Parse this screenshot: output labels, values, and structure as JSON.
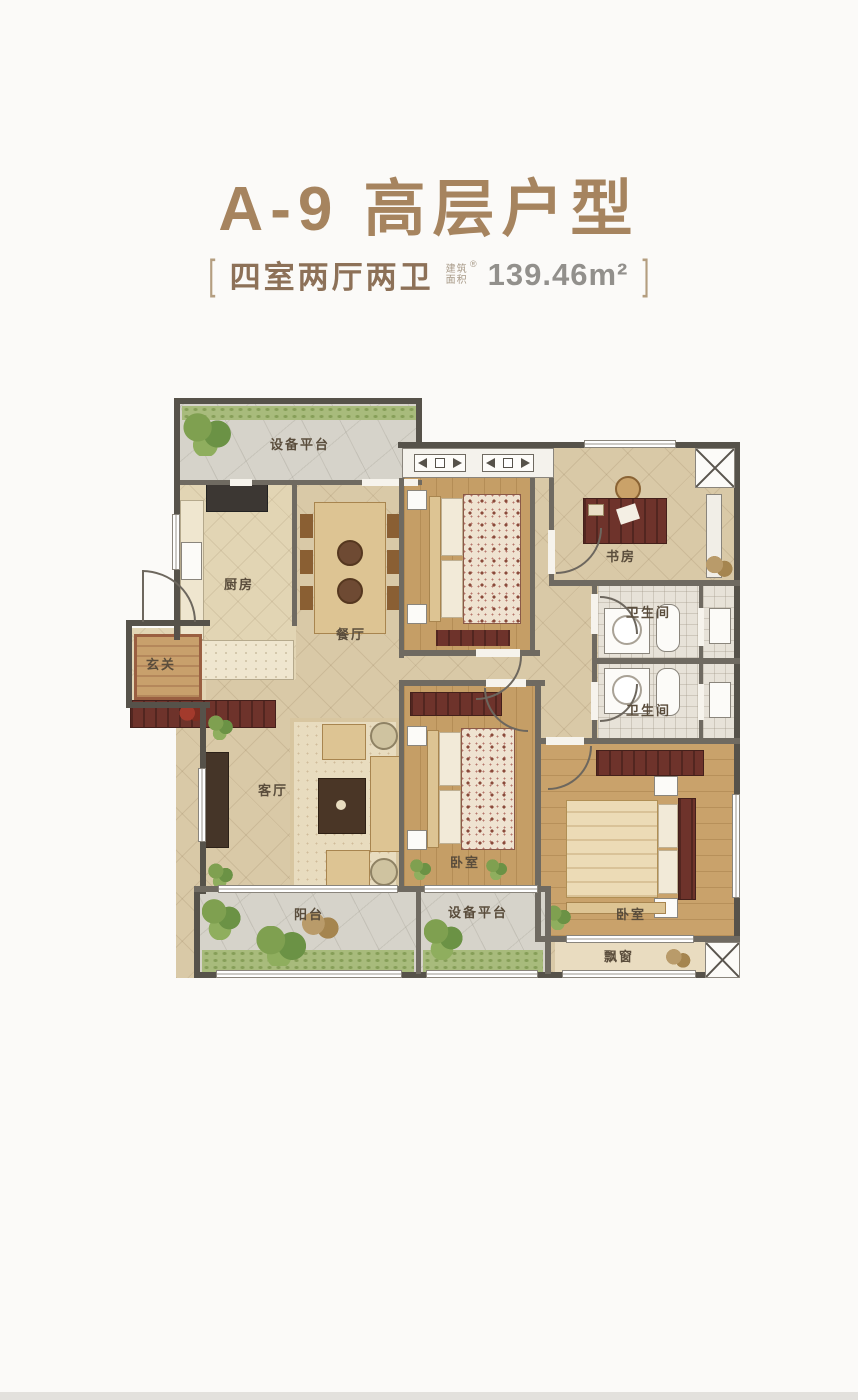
{
  "header": {
    "title": "A-9 高层户型",
    "bracket_left": "[",
    "layout_label": "四室两厅两卫",
    "area_label_line1": "建筑",
    "area_label_line2": "面积",
    "registered_mark": "®",
    "area_value": "139.46m²",
    "bracket_right": "]"
  },
  "plan": {
    "equip_top": "设备平台",
    "kitchen": "厨房",
    "dining": "餐厅",
    "study": "书房",
    "bath_upper": "卫生间",
    "bath_lower": "卫生间",
    "entry": "玄关",
    "living": "客厅",
    "bedroom_mid": "卧室",
    "bedroom_master": "卧室",
    "balcony": "阳台",
    "equip_bottom": "设备平台",
    "bay_window": "飘窗"
  },
  "colors": {
    "title_brown": "#a6845f",
    "wall_dark": "#56524a",
    "floor_tile": "#d9c9a7",
    "floor_wood": "#c59e66",
    "accent_maroon": "#6e332b",
    "paving_gray": "#d6d3ca",
    "grass_green": "#a8bb7c"
  }
}
